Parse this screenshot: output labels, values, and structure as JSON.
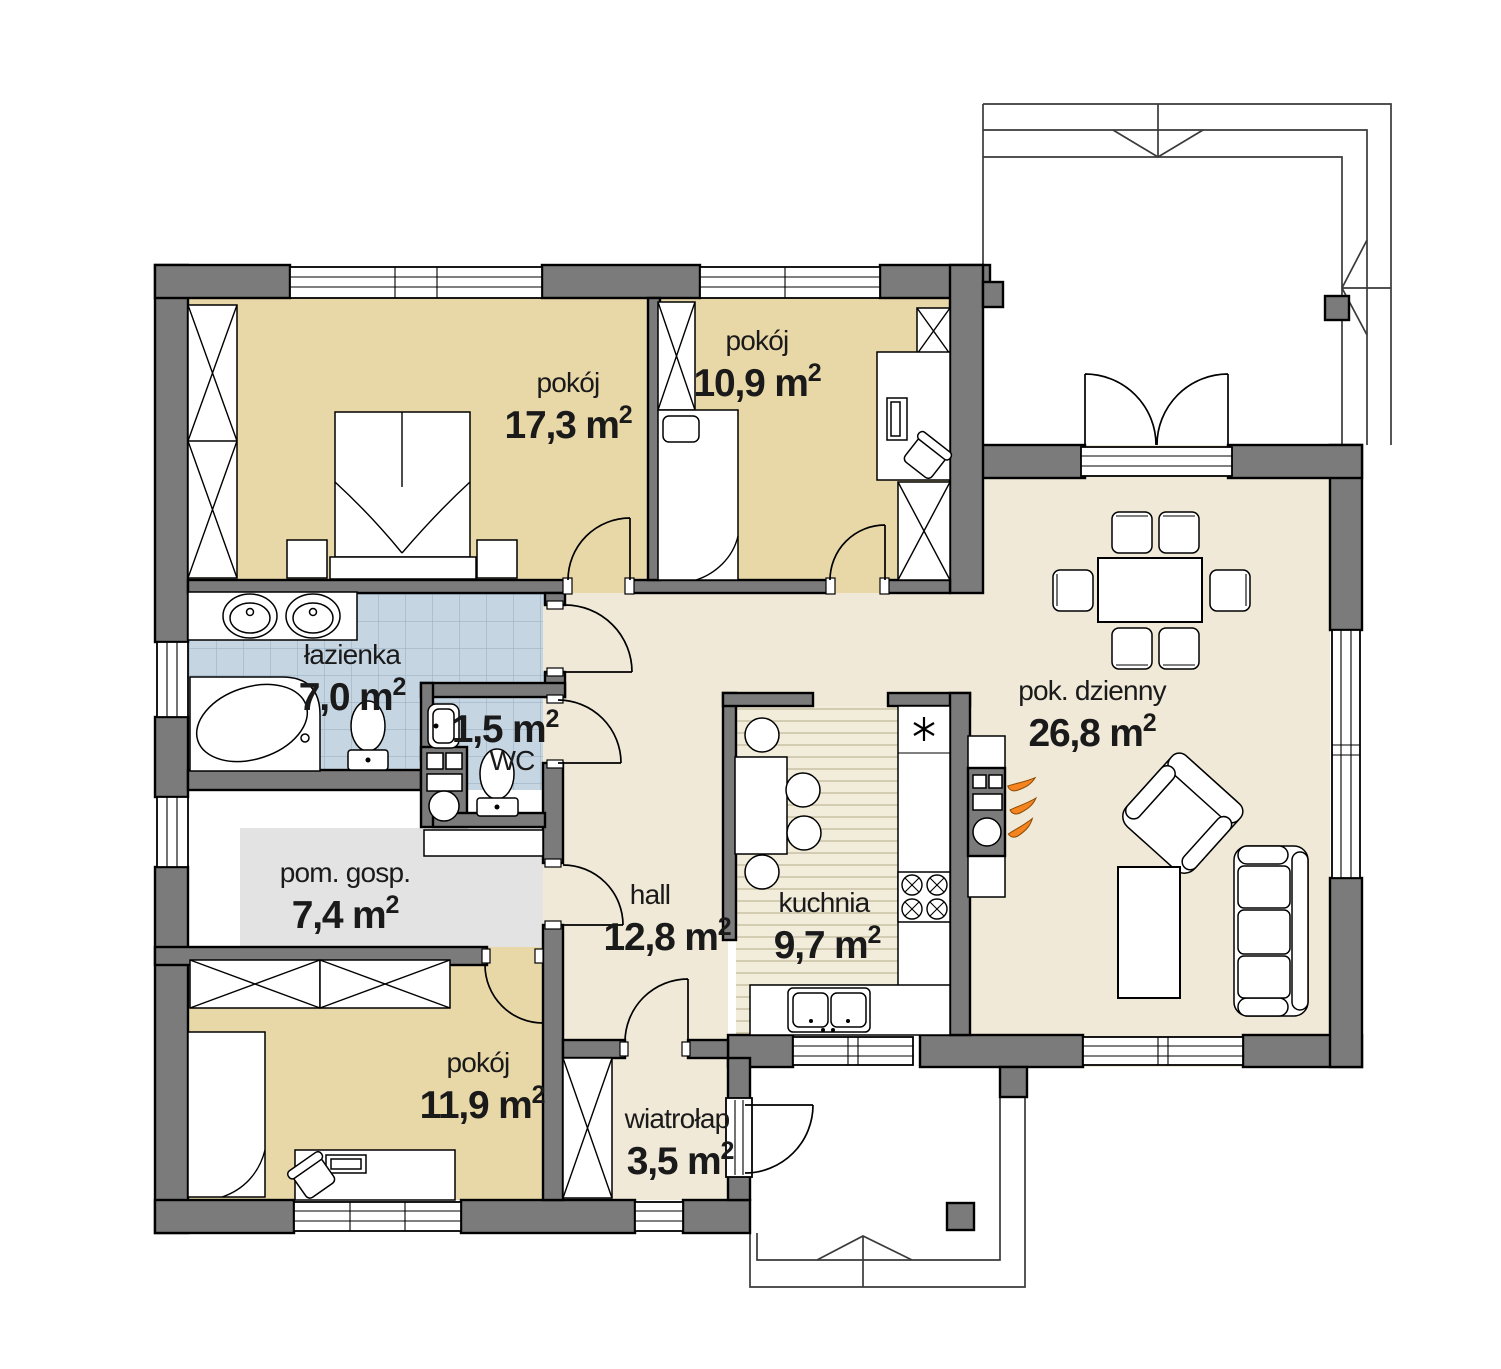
{
  "plan": {
    "colors": {
      "wall": "#7b7b7b",
      "bedroom": "#e8d8a8",
      "living": "#f0e9d8",
      "kitchen": "#f2ecdb",
      "kitchen_stripe": "#c9c0a4",
      "bath": "#c6d5e2",
      "bath_grid": "#9db3c5",
      "utility": "#e3e3e3",
      "flame": "#f5831f",
      "text": "#1a1a1a"
    },
    "rooms": [
      {
        "id": "pokoj-1",
        "name": "pokój",
        "area": "17,3 m",
        "sup": "2"
      },
      {
        "id": "pokoj-2",
        "name": "pokój",
        "area": "10,9 m",
        "sup": "2"
      },
      {
        "id": "pok-dzienny",
        "name": "pok. dzienny",
        "area": "26,8 m",
        "sup": "2"
      },
      {
        "id": "lazienka",
        "name": "łazienka",
        "area": "7,0 m",
        "sup": "2"
      },
      {
        "id": "wc",
        "name": "WC",
        "area": "1,5 m",
        "sup": "2"
      },
      {
        "id": "pom-gosp",
        "name": "pom. gosp.",
        "area": "7,4 m",
        "sup": "2"
      },
      {
        "id": "pokoj-3",
        "name": "pokój",
        "area": "11,9 m",
        "sup": "2"
      },
      {
        "id": "hall",
        "name": "hall",
        "area": "12,8 m",
        "sup": "2"
      },
      {
        "id": "kuchnia",
        "name": "kuchnia",
        "area": "9,7 m",
        "sup": "2"
      },
      {
        "id": "wiatrolap",
        "name": "wiatrołap",
        "area": "3,5 m",
        "sup": "2"
      }
    ]
  }
}
